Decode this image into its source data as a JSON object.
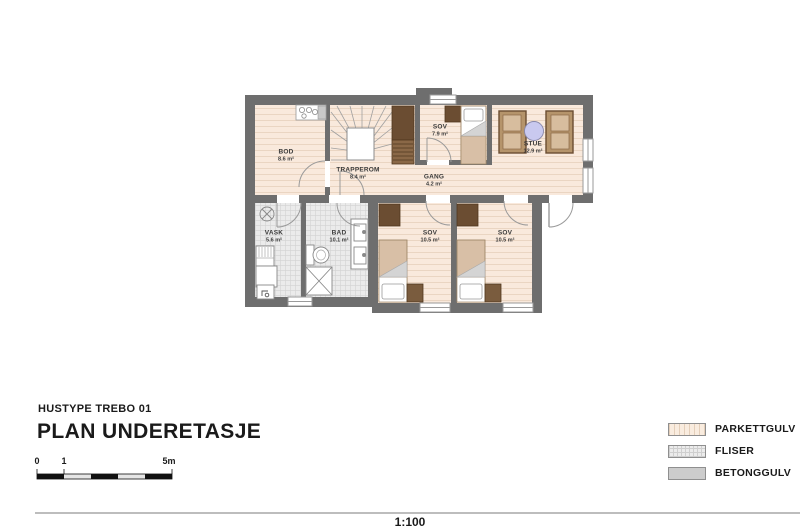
{
  "title_block": {
    "project": "HUSTYPE TREBO 01",
    "drawing_title": "PLAN UNDERETASJE",
    "scale_text": "1:100"
  },
  "scale_bar": {
    "labels": [
      "0",
      "1",
      "5m"
    ]
  },
  "legend": {
    "items": [
      {
        "label": "PARKETTGULV",
        "type": "parquet"
      },
      {
        "label": "FLISER",
        "type": "tiles"
      },
      {
        "label": "BETONGGULV",
        "type": "concrete"
      }
    ]
  },
  "rooms": [
    {
      "name": "BOD",
      "area": "8.6 m²"
    },
    {
      "name": "TRAPPEROM",
      "area": "8.4 m²"
    },
    {
      "name": "SOV",
      "area": "7.9 m²"
    },
    {
      "name": "STUE",
      "area": "12.9 m²"
    },
    {
      "name": "GANG",
      "area": "4.2 m²"
    },
    {
      "name": "VASK",
      "area": "5.6 m²"
    },
    {
      "name": "BAD",
      "area": "10.1 m²"
    },
    {
      "name": "SOV",
      "area": "10.5 m²"
    },
    {
      "name": "SOV",
      "area": "10.5 m²"
    }
  ],
  "colors": {
    "wall": "#6e6e6e",
    "parquet": "#f9e9dc",
    "tiles": "#ececec",
    "concrete": "#cccccc",
    "wood_dark": "#6b4d32",
    "wood_light": "#d8bfa6",
    "table_accent": "#c9c9ef"
  }
}
